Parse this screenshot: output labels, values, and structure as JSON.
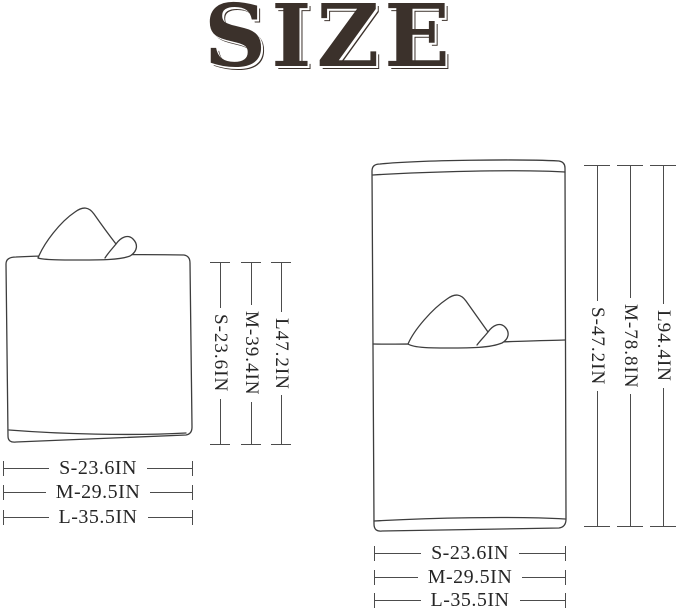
{
  "title": "SIZE",
  "colors": {
    "background": "#ffffff",
    "title": "#3b312b",
    "dimension_line": "#4c4c4c",
    "label_text": "#262626",
    "illustration_line": "#3d3d3d"
  },
  "left_figure": {
    "icon": "folded-hooded-towel-illustration",
    "height_labels": [
      "S-23.6IN",
      "M-39.4IN",
      "L47.2IN"
    ],
    "width_labels": [
      "S-23.6IN",
      "M-29.5IN",
      "L-35.5IN"
    ]
  },
  "right_figure": {
    "icon": "unfolded-hooded-towel-illustration",
    "height_labels": [
      "S-47.2IN",
      "M-78.8IN",
      "L94.4IN"
    ],
    "width_labels": [
      "S-23.6IN",
      "M-29.5IN",
      "L-35.5IN"
    ]
  }
}
